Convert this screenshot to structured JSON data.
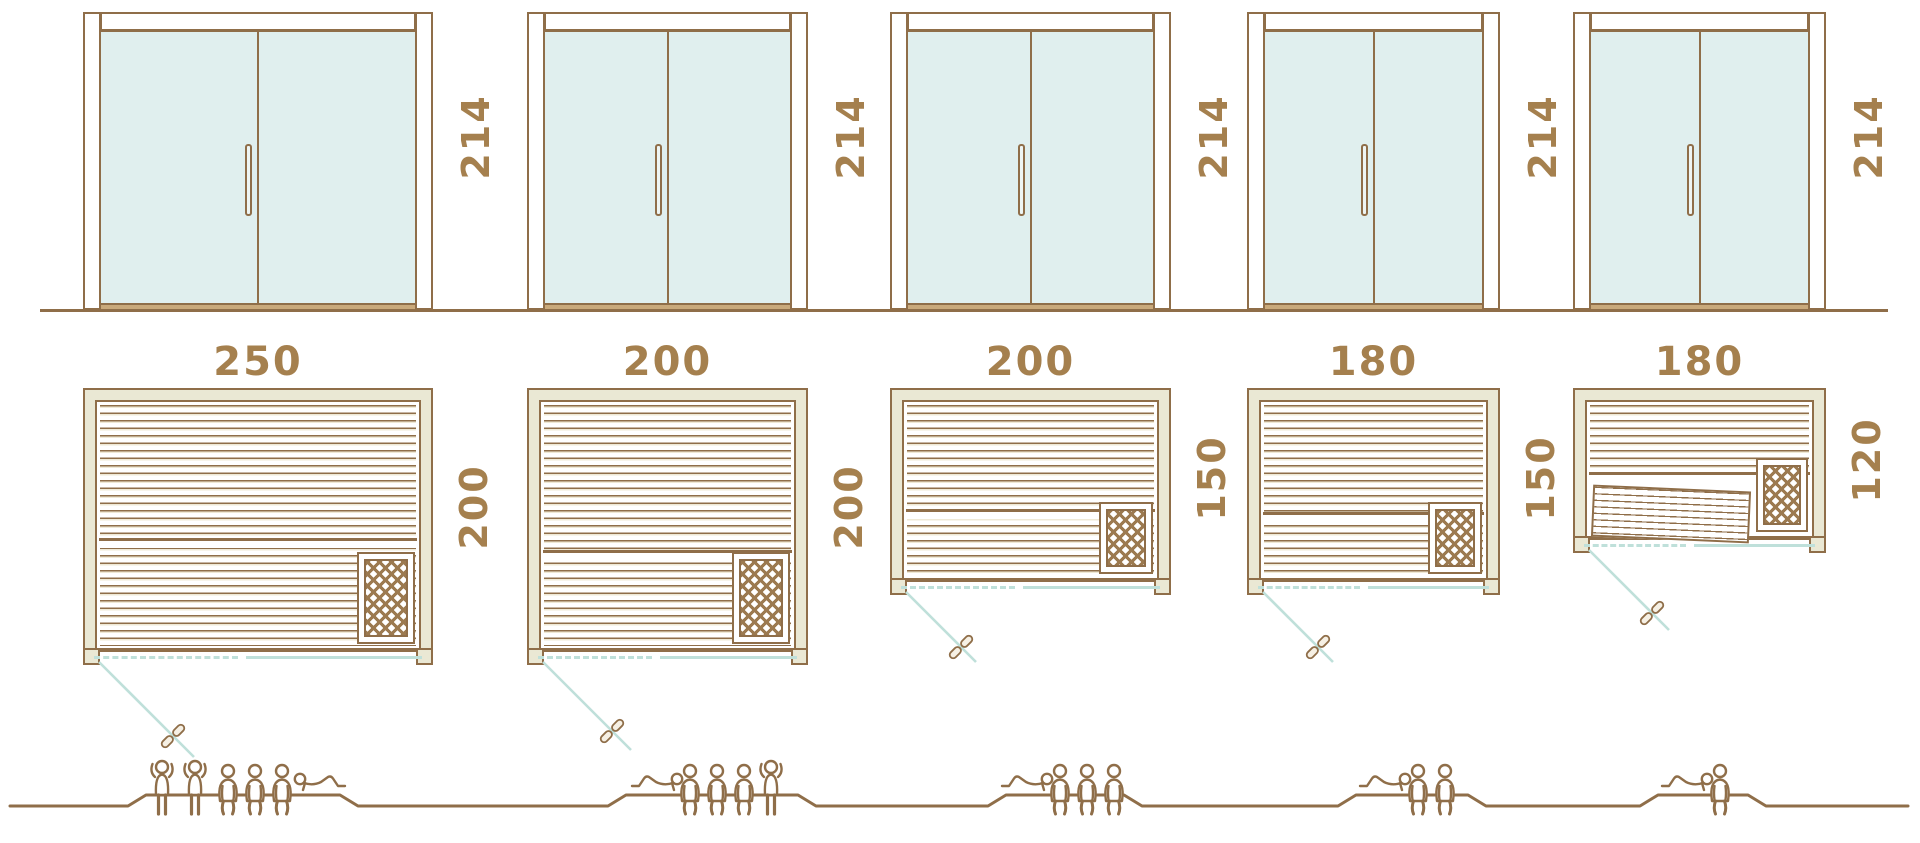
{
  "diagram": {
    "type": "sauna-size-comparison",
    "rows": [
      "glass-front-elevation",
      "floor-plan",
      "capacity-figures"
    ],
    "units": [
      {
        "door_height": "214",
        "width": "250",
        "depth": "200",
        "capacity": 6,
        "postures": [
          "standing",
          "standing",
          "sitting",
          "sitting",
          "sitting",
          "lying"
        ]
      },
      {
        "door_height": "214",
        "width": "200",
        "depth": "200",
        "capacity": 5,
        "postures": [
          "lying",
          "sitting",
          "sitting",
          "sitting",
          "standing"
        ]
      },
      {
        "door_height": "214",
        "width": "200",
        "depth": "150",
        "capacity": 4,
        "postures": [
          "lying",
          "sitting",
          "sitting",
          "sitting"
        ]
      },
      {
        "door_height": "214",
        "width": "180",
        "depth": "150",
        "capacity": 3,
        "postures": [
          "lying",
          "sitting",
          "sitting"
        ]
      },
      {
        "door_height": "214",
        "width": "180",
        "depth": "120",
        "capacity": 2,
        "postures": [
          "lying",
          "sitting"
        ]
      }
    ],
    "icons": {
      "heater": "heater-grid-icon",
      "door_handle": "door-handle-icon",
      "swing_handle": "swing-door-handle-icon",
      "people": [
        "person-standing-icon",
        "person-sitting-icon",
        "person-lying-icon"
      ]
    },
    "colors": {
      "outline_brown": "#8f6e49",
      "label_brown": "#a5804e",
      "wall_beige": "#eae8d4",
      "glass_teal": "#e0efee",
      "teal_line": "#bfe0da",
      "sill_tan": "#c9a97b",
      "background": "#ffffff"
    }
  }
}
